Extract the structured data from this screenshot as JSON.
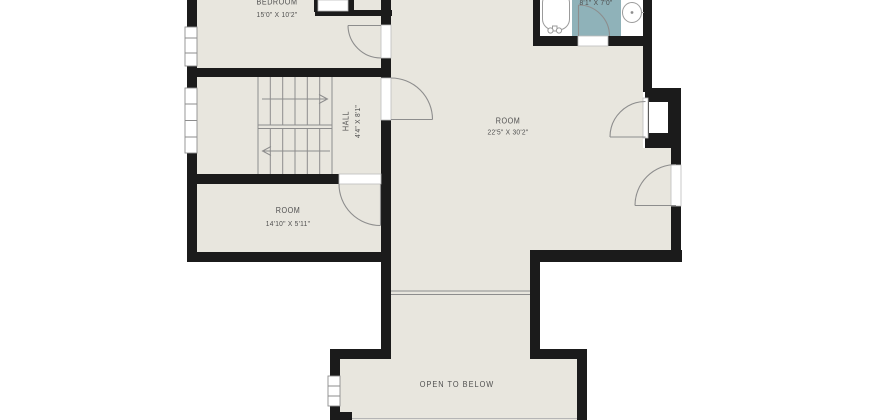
{
  "colors": {
    "background": "#ffffff",
    "floor": "#e8e6de",
    "wall": "#1b1b1b",
    "tile": "#8fb2b9",
    "line": "#8d8d8d",
    "jamb": "#bdbdbd",
    "fixture": "#ffffff",
    "faint": "#b5b5b5",
    "text": "#4f4f4f"
  },
  "labels": {
    "bedroom": {
      "name": "BEDROOM",
      "dims": "15'0\" X 10'2\""
    },
    "bathroom": {
      "dims": "8'1\" X 7'0\""
    },
    "hall": {
      "name": "HALL",
      "dims": "4'4\" X 8'1\""
    },
    "main_room": {
      "name": "ROOM",
      "dims": "22'5\" X 30'2\""
    },
    "small_room": {
      "name": "ROOM",
      "dims": "14'10\" X 5'11\""
    },
    "open_to_below": {
      "name": "OPEN TO BELOW"
    }
  }
}
